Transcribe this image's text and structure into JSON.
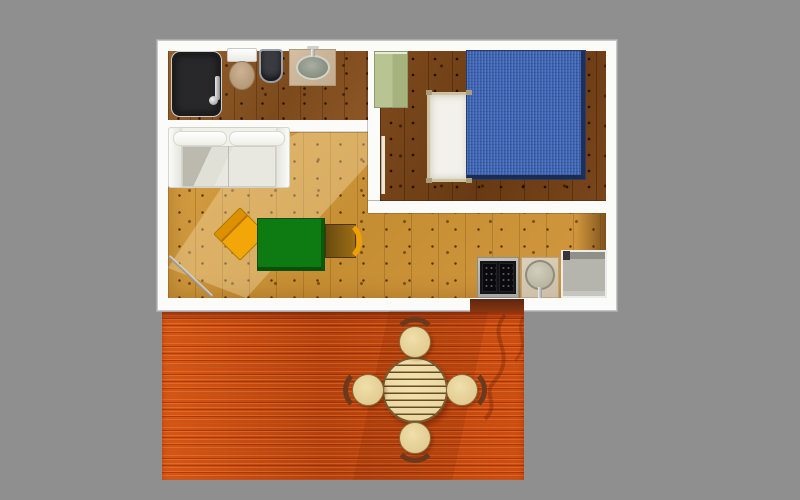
{
  "scene": {
    "type": "3d-floor-plan-top-view-render",
    "title": "",
    "visible_text": [],
    "colors": {
      "background": "#8f8f8f",
      "wall": "#fbfbfa",
      "floor_light": "#cd9740",
      "floor_dark": "#774419",
      "floor_bath": "#8a5424",
      "deck": "#c8480e",
      "bed_blue": "#4169b8",
      "bed_frame": "#cfc29e",
      "cabinet_green": "#b8c492",
      "desk_green": "#0e7a12",
      "chair_yellow": "#f2a607",
      "tub_black": "#28282b",
      "appliance_gray": "#b5b5ae",
      "table_wood": "#e7d49a",
      "stool_wood": "#ddc488",
      "arc_brown": "#6b3a1e"
    },
    "rooms": [
      {
        "name": "bathroom",
        "position": "top-left",
        "floor": "medium oak",
        "items": [
          "bathtub-black",
          "toilet",
          "bidet",
          "washbasin-on-counter"
        ]
      },
      {
        "name": "bedroom",
        "position": "top-right",
        "floor": "dark walnut",
        "items": [
          "wardrobe-green",
          "single-bed-white",
          "double-bed-blue",
          "open-door"
        ]
      },
      {
        "name": "living-room",
        "position": "center-left",
        "floor": "light pine",
        "items": [
          "sofa-white",
          "armchair-yellow-rotated",
          "desk-green",
          "side-chair-brown",
          "entrance-door-ajar"
        ]
      },
      {
        "name": "kitchenette",
        "position": "bottom-right-inside",
        "floor": "light pine",
        "items": [
          "stove-two-burners",
          "round-sink",
          "refrigerator-gray"
        ]
      },
      {
        "name": "terrace",
        "position": "bottom",
        "floor": "red-orange decking",
        "items": [
          "round-slatted-table",
          "stool-north",
          "stool-south",
          "stool-west",
          "stool-east",
          "door-opening-to-deck",
          "cast-shadows"
        ]
      }
    ]
  }
}
